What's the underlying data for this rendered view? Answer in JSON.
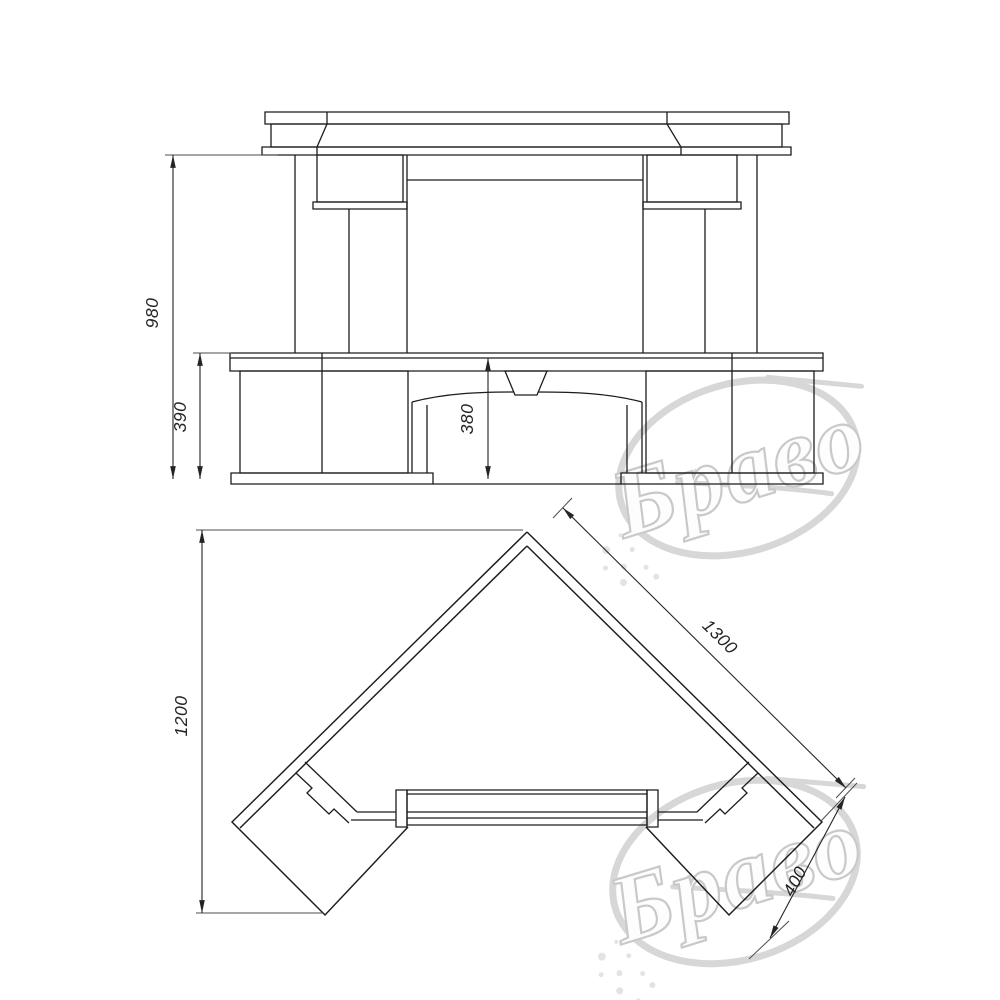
{
  "meta": {
    "type": "furniture-technical-drawing",
    "colors": {
      "paper": "#ffffff",
      "ink": "#1c1c1c",
      "dim": "#242424",
      "watermark": "#d7d7d7"
    }
  },
  "views": {
    "elevation": {
      "id": "front-elevation",
      "dimensions": [
        {
          "id": "height-overall",
          "value": "980"
        },
        {
          "id": "height-base",
          "value": "390"
        },
        {
          "id": "height-arch-recess",
          "value": "380"
        }
      ]
    },
    "plan": {
      "id": "top-plan",
      "dimensions": [
        {
          "id": "depth-overall",
          "value": "1200"
        },
        {
          "id": "back-wall-length",
          "value": "1300"
        },
        {
          "id": "wing-depth",
          "value": "400"
        }
      ]
    }
  },
  "watermarks": [
    {
      "text": "Браво"
    },
    {
      "text": "Браво"
    }
  ]
}
